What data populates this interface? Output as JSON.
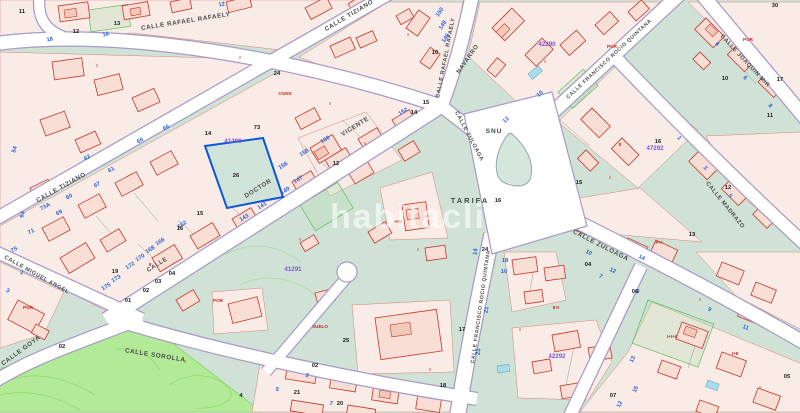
{
  "map": {
    "watermark": "habitaclia",
    "colors": {
      "background": "#cfe2d5",
      "park": "#b2ea97",
      "parcel_fill": "#f9ebe6",
      "building_fill": "#f8ded4",
      "building_stroke": "#c5372b",
      "street_fill": "#ffffff",
      "street_casing": "#a79bc9",
      "blue_number": "#2d63d6",
      "red_code": "#c4281e",
      "purple_id": "#7a58d8",
      "highlight": "#0a57d7",
      "pool": "#aadcec"
    },
    "highlighted_parcel": {
      "number": "26",
      "block_id": "41290"
    },
    "street_names": [
      [
        "CALLE RAFAEL RAFAELY",
        186,
        23,
        -9,
        6.3
      ],
      [
        "CALLE RAFAEL RAFAELY",
        447,
        58,
        -79,
        5.6
      ],
      [
        "NAVARRO",
        469,
        60,
        -55,
        6.1
      ],
      [
        "CALLE TIZIANO",
        62,
        189,
        -29,
        6.3
      ],
      [
        "CALLE TIZIANO",
        350,
        17,
        -31,
        6.3
      ],
      [
        "VICENTE",
        356,
        128,
        -32,
        6.3
      ],
      [
        "DOCTOR",
        259,
        190,
        -32,
        6.3
      ],
      [
        "CALLE",
        158,
        266,
        -32,
        6.0
      ],
      [
        "CALLE ZULOAGA",
        468,
        137,
        62,
        5.6
      ],
      [
        "CALLE FRANCISCO ROCIO QUINTANA",
        610,
        60,
        -43,
        5.2
      ],
      [
        "CALLE JOAQUIN MIR",
        744,
        62,
        47,
        5.8
      ],
      [
        "CALLE MADRAZO",
        724,
        206,
        51,
        5.8
      ],
      [
        "CALLE ZULOAGA",
        600,
        247,
        27,
        6.3
      ],
      [
        "CALLE FRANCISCO ROCIO QUINTANA",
        482,
        307,
        -82,
        5.2
      ],
      [
        "CALLE MIGUEL ANGEL",
        36,
        276,
        29,
        5.6
      ],
      [
        "CALLE GOYA",
        22,
        352,
        -36,
        6.3
      ],
      [
        "CALLE SOROLLA",
        155,
        357,
        9,
        6.3
      ]
    ],
    "zone_labels": [
      [
        "TARIFA",
        470,
        203,
        0,
        7.5,
        2
      ],
      [
        "SNU",
        494,
        133,
        0,
        6.5,
        1
      ]
    ],
    "block_ids": [
      [
        "41291",
        293,
        271
      ],
      [
        "41290",
        233,
        143
      ],
      [
        "42290",
        547,
        46
      ],
      [
        "47292",
        655,
        150
      ],
      [
        "42292",
        557,
        358
      ]
    ],
    "street_numbers_blue": [
      [
        "12",
        222,
        6,
        -12
      ],
      [
        "16",
        106,
        36,
        -12
      ],
      [
        "18",
        50,
        41,
        -10
      ],
      [
        "54",
        16,
        150,
        -72
      ],
      [
        "64",
        24,
        215,
        -72
      ],
      [
        "60",
        70,
        198,
        -29
      ],
      [
        "61",
        112,
        171,
        -29
      ],
      [
        "62",
        88,
        159,
        -29
      ],
      [
        "65",
        141,
        142,
        -29
      ],
      [
        "66",
        167,
        129,
        -29
      ],
      [
        "67",
        98,
        186,
        -29
      ],
      [
        "69",
        60,
        214,
        -29
      ],
      [
        "71",
        32,
        233,
        -29
      ],
      [
        "73A",
        46,
        208,
        -29
      ],
      [
        "75",
        15,
        251,
        -29
      ],
      [
        "152",
        404,
        113,
        -32
      ],
      [
        "160",
        326,
        141,
        -32
      ],
      [
        "158",
        305,
        154,
        -32
      ],
      [
        "156",
        284,
        167,
        -32
      ],
      [
        "147",
        299,
        181,
        -32
      ],
      [
        "149",
        286,
        192,
        -32
      ],
      [
        "141",
        263,
        207,
        -32
      ],
      [
        "143",
        245,
        219,
        -32
      ],
      [
        "162",
        183,
        226,
        -32
      ],
      [
        "166",
        161,
        243,
        -32
      ],
      [
        "168",
        151,
        251,
        -32
      ],
      [
        "170",
        141,
        259,
        -32
      ],
      [
        "172",
        131,
        267,
        -32
      ],
      [
        "173",
        117,
        280,
        -32
      ],
      [
        "175",
        107,
        288,
        -32
      ],
      [
        "150",
        441,
        13,
        -55
      ],
      [
        "148",
        444,
        26,
        -55
      ],
      [
        "146",
        447,
        39,
        -55
      ],
      [
        "14",
        477,
        252,
        -82
      ],
      [
        "21",
        488,
        310,
        -82
      ],
      [
        "23",
        480,
        352,
        -82
      ],
      [
        "18",
        505,
        262,
        0
      ],
      [
        "10",
        504,
        273,
        0
      ],
      [
        "12",
        507,
        121,
        -43
      ],
      [
        "10",
        541,
        95,
        -43
      ],
      [
        "10",
        588,
        254,
        26
      ],
      [
        "12",
        612,
        272,
        26
      ],
      [
        "14",
        641,
        259,
        26
      ],
      [
        "7",
        600,
        278,
        26
      ],
      [
        "9",
        637,
        293,
        26
      ],
      [
        "9",
        709,
        311,
        23
      ],
      [
        "11",
        745,
        329,
        23
      ],
      [
        "13",
        634,
        360,
        -64
      ],
      [
        "15",
        637,
        390,
        -64
      ],
      [
        "12",
        621,
        405,
        -64
      ],
      [
        "1",
        678,
        139,
        51
      ],
      [
        "3",
        704,
        169,
        51
      ],
      [
        "5",
        729,
        197,
        51
      ],
      [
        "4",
        716,
        45,
        47
      ],
      [
        "6",
        744,
        79,
        47
      ],
      [
        "8",
        769,
        107,
        47
      ],
      [
        "2",
        307,
        377,
        11
      ],
      [
        "5",
        277,
        391,
        11
      ],
      [
        "7",
        331,
        405,
        11
      ],
      [
        "1",
        21,
        274,
        29
      ],
      [
        "3",
        7,
        292,
        29
      ]
    ],
    "parcel_numbers_black": [
      [
        "11",
        22,
        13
      ],
      [
        "12",
        76,
        33
      ],
      [
        "13",
        117,
        25
      ],
      [
        "14",
        208,
        135
      ],
      [
        "73",
        257,
        129
      ],
      [
        "26",
        236,
        177
      ],
      [
        "15",
        200,
        215
      ],
      [
        "16",
        180,
        230
      ],
      [
        "24",
        277,
        75
      ],
      [
        "10",
        435,
        54
      ],
      [
        "15",
        426,
        104
      ],
      [
        "14",
        414,
        114
      ],
      [
        "30",
        775,
        7
      ],
      [
        "17",
        780,
        81
      ],
      [
        "10",
        725,
        80
      ],
      [
        "11",
        770,
        117
      ],
      [
        "16",
        658,
        143
      ],
      [
        "12",
        728,
        189
      ],
      [
        "13",
        692,
        236
      ],
      [
        "15",
        579,
        184
      ],
      [
        "16",
        498,
        202
      ],
      [
        "12",
        336,
        165
      ],
      [
        "24",
        485,
        251
      ],
      [
        "04",
        588,
        266
      ],
      [
        "06",
        635,
        293
      ],
      [
        "17",
        462,
        331
      ],
      [
        "07",
        613,
        397
      ],
      [
        "05",
        787,
        378
      ],
      [
        "25",
        346,
        342
      ],
      [
        "21",
        297,
        394
      ],
      [
        "20",
        340,
        405
      ],
      [
        "18",
        443,
        387
      ],
      [
        "03",
        158,
        283
      ],
      [
        "04",
        172,
        275
      ],
      [
        "01",
        128,
        302
      ],
      [
        "02",
        146,
        292
      ],
      [
        "19",
        115,
        273
      ],
      [
        "02",
        62,
        348
      ],
      [
        "02",
        315,
        367
      ],
      [
        "4",
        241,
        397
      ]
    ],
    "building_codes_red": [
      [
        "CONS",
        285,
        95
      ],
      [
        "SUELO",
        320,
        328
      ],
      [
        "POR",
        218,
        302
      ],
      [
        "POR",
        748,
        41
      ],
      [
        "POR",
        612,
        48
      ],
      [
        "P+I",
        659,
        244
      ],
      [
        "I+I+II",
        672,
        338
      ],
      [
        "-I+II",
        398,
        223
      ],
      [
        "II+I",
        556,
        309
      ],
      [
        "POR",
        28,
        309
      ],
      [
        "I",
        97,
        67
      ],
      [
        "I",
        240,
        59
      ],
      [
        "I",
        330,
        105
      ],
      [
        "I",
        300,
        241
      ],
      [
        "I",
        418,
        251
      ],
      [
        "I",
        610,
        179
      ],
      [
        "I",
        700,
        301
      ],
      [
        "I",
        185,
        363
      ],
      [
        "I",
        520,
        331
      ],
      [
        "I",
        760,
        389
      ],
      [
        "I",
        430,
        371
      ],
      [
        "II",
        150,
        266
      ],
      [
        "II",
        620,
        146
      ],
      [
        "I+II",
        735,
        355
      ],
      [
        "I",
        545,
        63
      ],
      [
        "I",
        365,
        145
      ],
      [
        "I",
        408,
        36
      ]
    ]
  }
}
